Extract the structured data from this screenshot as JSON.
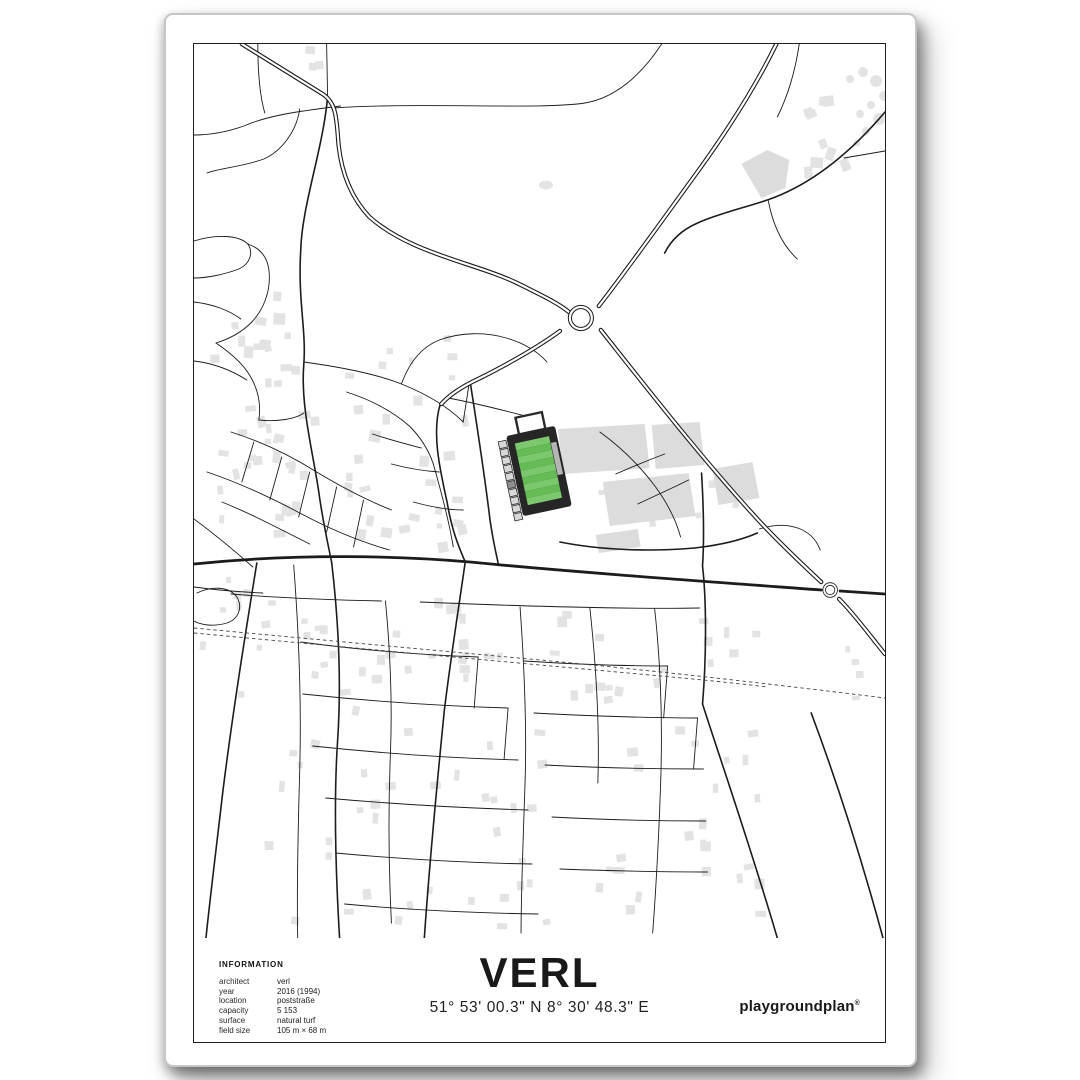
{
  "poster": {
    "title": "VERL",
    "coordinates": "51° 53' 00.3\" N 8° 30' 48.3\" E",
    "brand": {
      "name": "playgroundplan",
      "mark": "®"
    },
    "info": {
      "heading": "INFORMATION",
      "rows": [
        {
          "label": "architect",
          "value": "verl"
        },
        {
          "label": "year",
          "value": "2016 (1994)"
        },
        {
          "label": "location",
          "value": "poststraße"
        },
        {
          "label": "capacity",
          "value": "5 153"
        },
        {
          "label": "surface",
          "value": "natural turf"
        },
        {
          "label": "field size",
          "value": "105 m × 68 m"
        }
      ]
    },
    "map": {
      "colors": {
        "building": "#e3e3e3",
        "building_large": "#dcdcdc",
        "road": "#1c1c1c",
        "railway": "#474747",
        "stadium_structure": "#262626",
        "terrace": "#d8d8d8",
        "terrace_dark": "#8f8f8f",
        "stand_strip": "#b5b5b5",
        "pitch_stripe_light": "#7cc96d",
        "pitch_stripe_dark": "#65bb54"
      }
    }
  }
}
